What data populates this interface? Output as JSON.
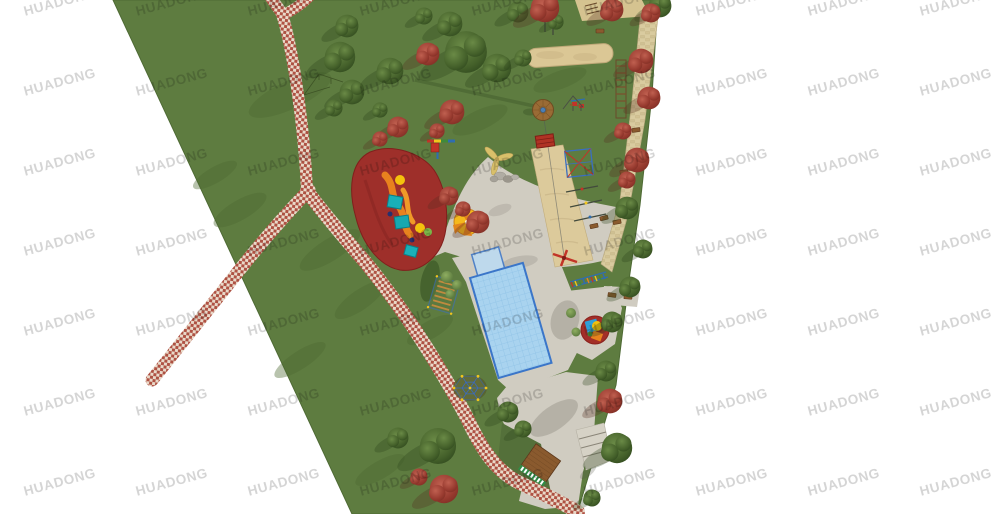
{
  "meta": {
    "description": "Top-down landscape rendering (site plan) of a park playground: large green lawn wedge on white background, red-and-white checkered pedestrian paths, central gray plaza with a blue obstacle-course pool, red rubber toddler play area with slides, zipline sand runway, sand pit, dome climber, wooden deck, stone side path with benches, green and red maple trees, and tiled HUADONG watermarks.",
    "type": "park playground aerial plan rendering"
  },
  "watermark": {
    "text": "HUADONG",
    "color": "#9a9a9a",
    "opacity": 0.42,
    "rotation_deg": -15,
    "x_start": 24,
    "y_start": 4,
    "x_step": 112,
    "y_step": 80,
    "cols": 9,
    "rows": 7
  },
  "colors": {
    "bg": "#ffffff",
    "grass": "#5e7c40",
    "grass_edge": "#4e6a34",
    "grass_shade": "#4e6a33",
    "plaza": "#d0ccc1",
    "sand": "#dbc795",
    "stone_path": "#d9cb9f",
    "checker_red": "#b05244",
    "checker_cream": "#e9d9c9",
    "pool_blue": "#a9d3ef",
    "pool_border": "#3b76c9",
    "rubber_red": "#9e2f2a",
    "tree_green": "#35511f",
    "tree_maple": "#9e473c",
    "wood": "#8a5a2e",
    "accent_yellow": "#f2c51c",
    "accent_orange": "#e8821e",
    "accent_teal": "#19b0b8",
    "accent_blue": "#2f6db0",
    "accent_red": "#c23428"
  },
  "features": {
    "zones": [
      {
        "name": "lawn",
        "label": "park lawn wedge"
      },
      {
        "name": "checkered-path",
        "label": "red/white checkered walking path with Y junctions"
      },
      {
        "name": "plaza",
        "label": "gray paved activity plaza"
      },
      {
        "name": "obstacle-pool",
        "label": "blue obstacle-course pad with ladder bridges, rings, colored balls"
      },
      {
        "name": "toddler-area",
        "label": "red rubber play area with orange slides and teal platforms"
      },
      {
        "name": "zipline",
        "label": "zipline with round wooden start platform and sand runway"
      },
      {
        "name": "sand-pit",
        "label": "long sand pit strip"
      },
      {
        "name": "dome-climber",
        "label": "geodesic dome climber"
      },
      {
        "name": "wood-deck",
        "label": "wooden deck with striped edge"
      },
      {
        "name": "stairs",
        "label": "stairs at south-east park exit"
      },
      {
        "name": "stone-path",
        "label": "stone side path with benches along east edge"
      },
      {
        "name": "spinner-pad",
        "label": "small round red pad with play sculpture"
      }
    ]
  },
  "scene": {
    "trees": [
      [
        347,
        26,
        12,
        "g"
      ],
      [
        340,
        57,
        16,
        "g"
      ],
      [
        352,
        92,
        13,
        "g"
      ],
      [
        334,
        108,
        9,
        "g"
      ],
      [
        390,
        71,
        14,
        "g"
      ],
      [
        466,
        52,
        22,
        "g"
      ],
      [
        450,
        24,
        13,
        "g"
      ],
      [
        497,
        68,
        15,
        "g"
      ],
      [
        518,
        12,
        11,
        "g"
      ],
      [
        424,
        16,
        9,
        "g"
      ],
      [
        523,
        58,
        9,
        "g"
      ],
      [
        556,
        22,
        8,
        "g"
      ],
      [
        660,
        6,
        12,
        "g"
      ],
      [
        627,
        208,
        12,
        "g"
      ],
      [
        643,
        249,
        10,
        "g"
      ],
      [
        630,
        287,
        11,
        "g"
      ],
      [
        612,
        322,
        11,
        "g"
      ],
      [
        606,
        371,
        11,
        "g"
      ],
      [
        617,
        448,
        16,
        "g"
      ],
      [
        592,
        498,
        9,
        "g"
      ],
      [
        438,
        446,
        19,
        "g"
      ],
      [
        398,
        438,
        11,
        "g"
      ],
      [
        508,
        412,
        11,
        "g"
      ],
      [
        523,
        429,
        9,
        "g"
      ],
      [
        380,
        110,
        8,
        "g"
      ],
      [
        545,
        8,
        15,
        "m"
      ],
      [
        612,
        10,
        12,
        "m"
      ],
      [
        651,
        13,
        10,
        "m"
      ],
      [
        428,
        54,
        12,
        "m"
      ],
      [
        398,
        127,
        11,
        "m"
      ],
      [
        380,
        139,
        8,
        "m"
      ],
      [
        641,
        61,
        13,
        "m"
      ],
      [
        649,
        98,
        12,
        "m"
      ],
      [
        637,
        160,
        13,
        "m"
      ],
      [
        627,
        180,
        9,
        "m"
      ],
      [
        452,
        112,
        13,
        "m"
      ],
      [
        437,
        131,
        8,
        "m"
      ],
      [
        449,
        196,
        10,
        "m"
      ],
      [
        463,
        209,
        8,
        "m"
      ],
      [
        478,
        222,
        12,
        "m"
      ],
      [
        623,
        131,
        9,
        "m"
      ],
      [
        610,
        401,
        13,
        "m"
      ],
      [
        444,
        489,
        15,
        "m"
      ],
      [
        419,
        477,
        9,
        "m"
      ]
    ],
    "bushes": [
      [
        447,
        277,
        6
      ],
      [
        457,
        285,
        5
      ],
      [
        450,
        294,
        4.5
      ],
      [
        571,
        313,
        5
      ],
      [
        576,
        332,
        4.5
      ]
    ],
    "lawn_shading": [
      [
        290,
        95,
        45,
        14,
        -25
      ],
      [
        240,
        210,
        30,
        10,
        -30
      ],
      [
        360,
        300,
        30,
        10,
        -35
      ],
      [
        430,
        330,
        26,
        9,
        -30
      ],
      [
        560,
        80,
        28,
        9,
        -20
      ],
      [
        480,
        120,
        30,
        10,
        -25
      ],
      [
        215,
        175,
        25,
        8,
        -30
      ],
      [
        380,
        470,
        28,
        9,
        -30
      ],
      [
        330,
        250,
        35,
        11,
        -32
      ],
      [
        300,
        360,
        30,
        9,
        -33
      ]
    ],
    "benches": [
      [
        641,
        58,
        -6
      ],
      [
        647,
        92,
        -5
      ],
      [
        636,
        130,
        -8
      ],
      [
        624,
        172,
        -8
      ],
      [
        617,
        222,
        -10
      ],
      [
        612,
        295,
        8
      ],
      [
        628,
        297,
        4
      ],
      [
        604,
        218,
        -15
      ],
      [
        600,
        31,
        0
      ],
      [
        594,
        226,
        -12
      ]
    ],
    "figures": [
      [
        456,
        236,
        -30,
        "#2c3440"
      ],
      [
        471,
        248,
        20,
        "#2c3440"
      ],
      [
        490,
        302,
        40,
        "#34495e"
      ],
      [
        521,
        300,
        -20,
        "#8a2d20"
      ],
      [
        476,
        353,
        10,
        "#2c3440"
      ],
      [
        503,
        360,
        -35,
        "#2c3440"
      ],
      [
        543,
        400,
        15,
        "#2c3440"
      ],
      [
        562,
        432,
        -25,
        "#34495e"
      ],
      [
        577,
        472,
        30,
        "#2c3440"
      ],
      [
        612,
        212,
        0,
        "#8a2d20"
      ],
      [
        586,
        264,
        -15,
        "#2c3440"
      ],
      [
        532,
        455,
        20,
        "#2c3440"
      ],
      [
        435,
        188,
        25,
        "#d35400"
      ],
      [
        522,
        190,
        0,
        "#2c3440"
      ],
      [
        553,
        310,
        0,
        "#2c3440"
      ]
    ],
    "pool_rows": [
      {
        "y": 8,
        "type": "ladder",
        "color": "#c0502f",
        "x1": -14,
        "x2": 52
      },
      {
        "y": 20,
        "type": "ladder",
        "color": "#d96b3a",
        "x1": 2,
        "x2": 52
      },
      {
        "y": 41,
        "type": "rings",
        "color": "#cc3333"
      },
      {
        "y": 56,
        "type": "ladder",
        "color": "#b98d5a",
        "x1": 6,
        "x2": 52
      },
      {
        "y": 69,
        "type": "ladder",
        "color": "#7a4a2e",
        "x1": 4,
        "x2": 50
      },
      {
        "y": 84,
        "type": "balls",
        "colors": [
          "#3f8a3a",
          "#f2c51c",
          "#c23428",
          "#ffffff",
          "#2f6db0",
          "#6c3483",
          "#ffffff",
          "#2f6db0",
          "#c23428"
        ]
      },
      {
        "y": 95,
        "type": "blocks",
        "colors": [
          "#a33b2a",
          "#3f7a3a"
        ]
      }
    ]
  }
}
